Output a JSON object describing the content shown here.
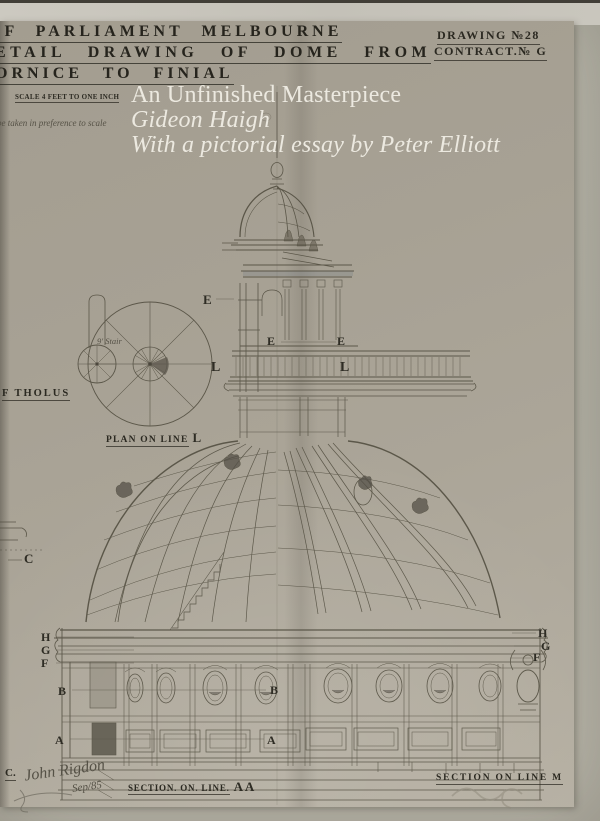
{
  "header": {
    "line1": "OF PARLIAMENT MELBOURNE",
    "line2": "ETAIL DRAWING OF DOME FROM",
    "line3": "ORNICE TO FINIAL",
    "drawing_no": "DRAWING №28",
    "contract_no": "CONTRACT.№ G"
  },
  "cover": {
    "title": "An Unfinished Masterpiece",
    "author": "Gideon Haigh",
    "subtitle": "With a pictorial essay by Peter Elliott"
  },
  "scale_block": {
    "scale": "SCALE 4 FEET TO ONE INCH",
    "note": "be taken in preference to scale"
  },
  "plan": {
    "tholus": "F THOLUS",
    "caption": "PLAN ON LINE",
    "caption_letter": "L",
    "stair_note": "9′ Stair"
  },
  "sections": {
    "left_caption": "SECTION. ON. LINE.",
    "left_letters": "A A",
    "right_caption": "SECTION ON LINE M"
  },
  "signature": {
    "prefix": "C.",
    "name": "John Rigdon",
    "date": "Sep/85"
  },
  "letters": {
    "a": "A",
    "b": "B",
    "c": "C",
    "e": "E",
    "f": "F",
    "g": "G",
    "h": "H",
    "l": "L"
  },
  "palette": {
    "sheet": "#a8a296",
    "margin": "#b8b6aa",
    "ink": "#4e4a3c",
    "stencil": "#26241d",
    "cover_text": "#ece9e0",
    "pencil": "#8e897b"
  }
}
